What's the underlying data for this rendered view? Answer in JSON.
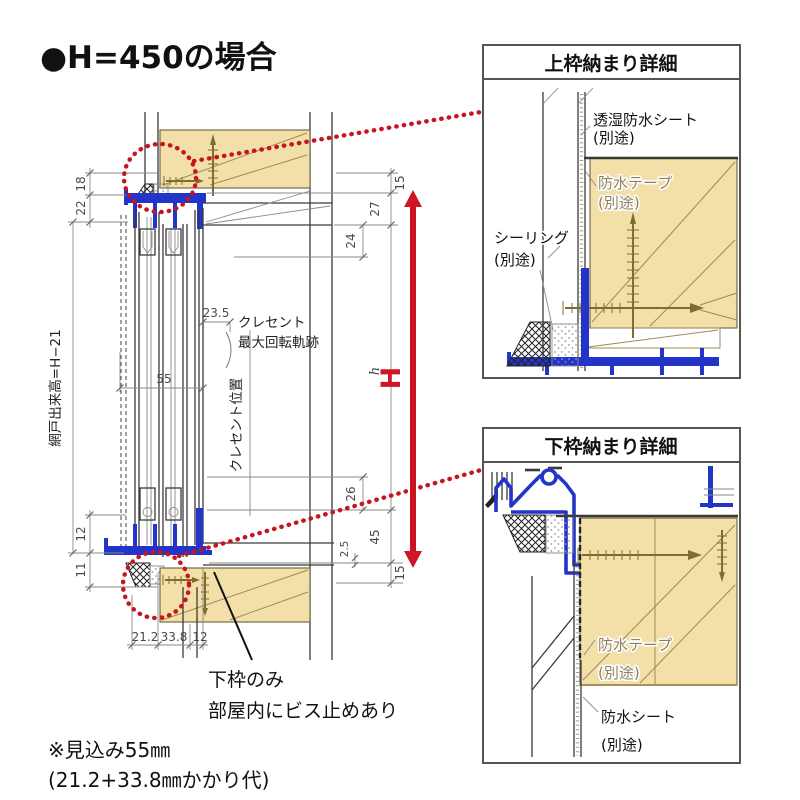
{
  "title": "●H=450の場合",
  "main": {
    "dims": {
      "left_18": "18",
      "left_22": "22",
      "left_12": "12",
      "left_11": "11",
      "bottom_21_2": "21.2",
      "bottom_33_8": "33.8",
      "bottom_12": "12",
      "right_15_top": "15",
      "right_27": "27",
      "right_24": "24",
      "right_26": "26",
      "right_45": "45",
      "right_2_5": "2.5",
      "right_15_bottom": "15",
      "width_55": "55",
      "crescent_23_5": "23.5",
      "h_inner": "h",
      "H_total": "H"
    },
    "labels": {
      "screen_height": "網戸出来高=H−21",
      "crescent_line1": "クレセント",
      "crescent_line2": "最大回転軌跡",
      "crescent_pos": "クレセント位置",
      "callout_line1": "下枠のみ",
      "callout_line2": "部屋内にビス止めあり"
    }
  },
  "detail_top": {
    "title": "上枠納まり詳細",
    "sheet_line1": "透湿防水シート",
    "sheet_line2": "(別途)",
    "tape_line1": "防水テープ",
    "tape_line2": "(別途)",
    "seal_line1": "シーリング",
    "seal_line2": "(別途)"
  },
  "detail_bottom": {
    "title": "下枠納まり詳細",
    "tape_line1": "防水テープ",
    "tape_line2": "(別途)",
    "sheet_line1": "防水シート",
    "sheet_line2": "(別途)"
  },
  "footnote": {
    "line1": "※見込み55㎜",
    "line2": "(21.2+33.8㎜かかり代)"
  },
  "colors": {
    "frame_blue": "#2334c8",
    "wood": "#f3dfa8",
    "callout_red": "#c9131f",
    "line_dark": "#3a3a3a"
  }
}
